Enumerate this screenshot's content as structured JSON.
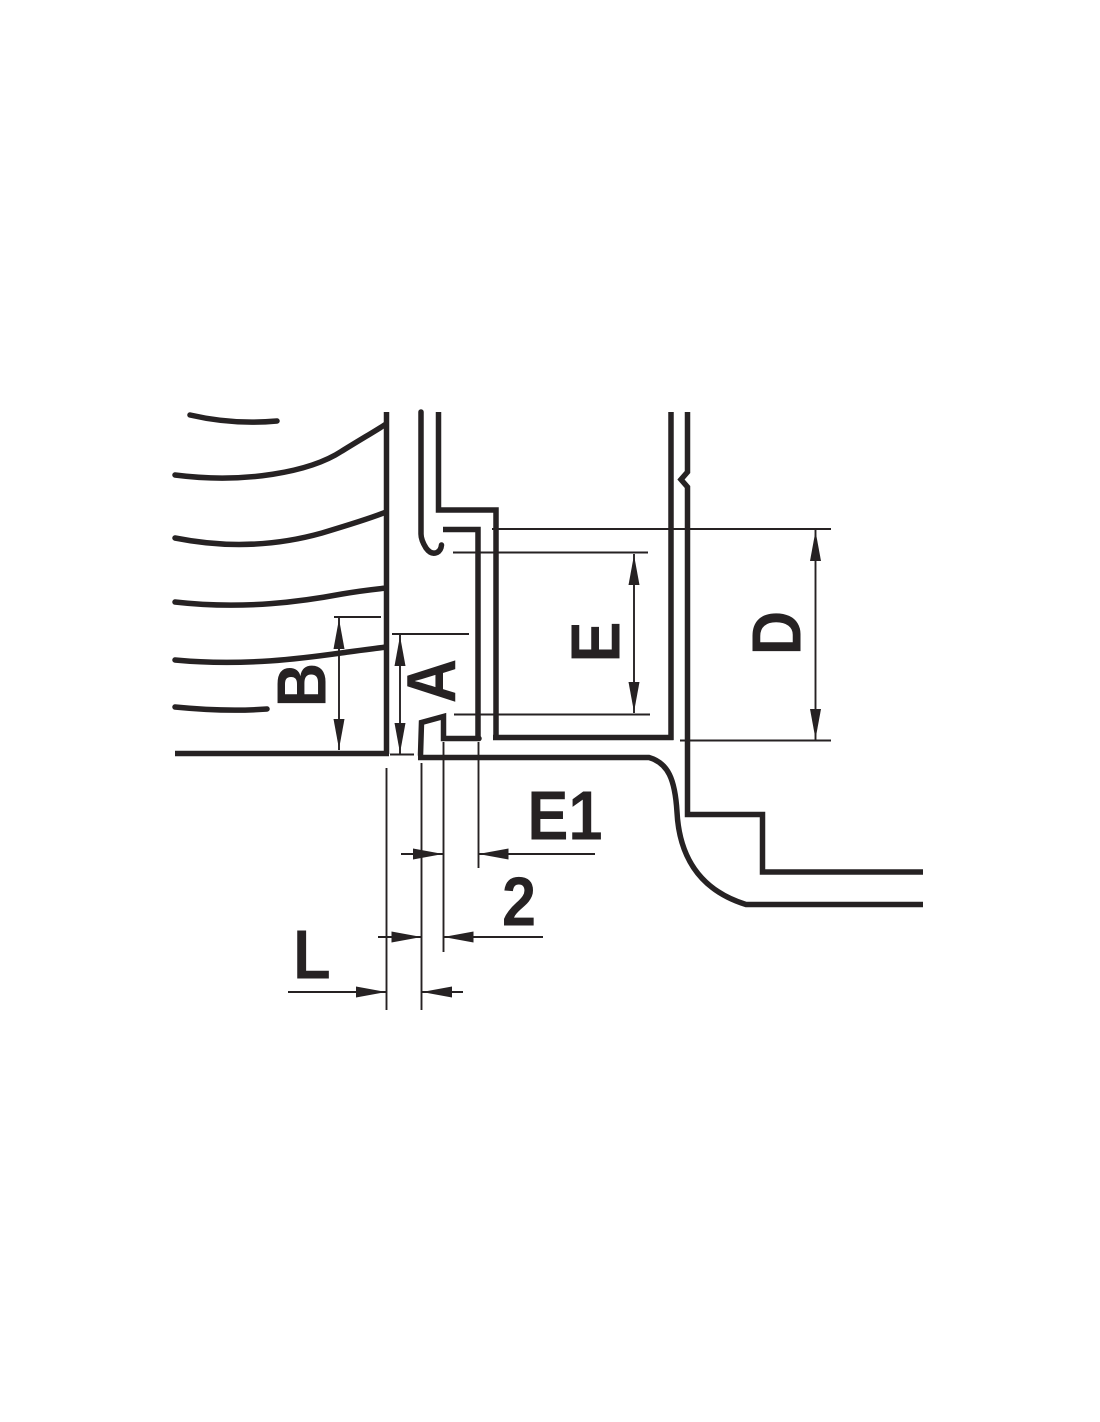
{
  "drawing": {
    "type": "technical-dimension-diagram",
    "labels": {
      "b": "B",
      "a": "A",
      "e": "E",
      "d": "D",
      "e1": "E1",
      "two": "2",
      "l": "L"
    }
  },
  "colors": {
    "line": "#262223",
    "background": "#ffffff"
  }
}
